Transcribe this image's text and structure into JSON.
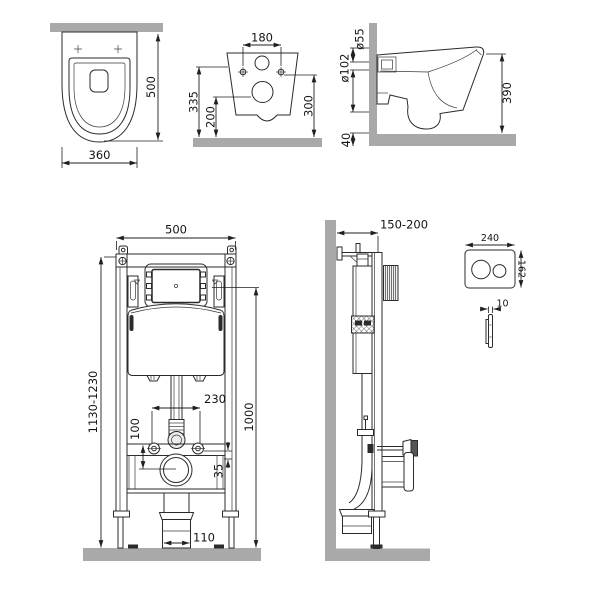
{
  "drawing": {
    "type": "technical-installation-diagram",
    "subject": "wall-hung toilet with concealed cistern frame and flush plate",
    "colors": {
      "line": "#2b2b2b",
      "masonry": "#a9a9a9",
      "text": "#141414",
      "background": "#ffffff"
    },
    "views": {
      "toilet_top": {
        "height": "500",
        "width": "360"
      },
      "toilet_rear": {
        "hole_spacing": "180",
        "inlet_height": "335",
        "outlet_height": "200",
        "holes_height": "300"
      },
      "toilet_side": {
        "inlet_diameter": "ø55",
        "outlet_diameter": "ø102",
        "height": "390",
        "clearance": "40"
      },
      "frame_front": {
        "width": "500",
        "height_range": "1130-1230",
        "panel_height": "1000",
        "stud_spacing": "230",
        "offset_100": "100",
        "offset_35": "35",
        "drain_width": "110"
      },
      "frame_side": {
        "depth_range": "150-200"
      },
      "flush_plate": {
        "width": "240",
        "height": "162",
        "thickness": "10"
      }
    }
  }
}
